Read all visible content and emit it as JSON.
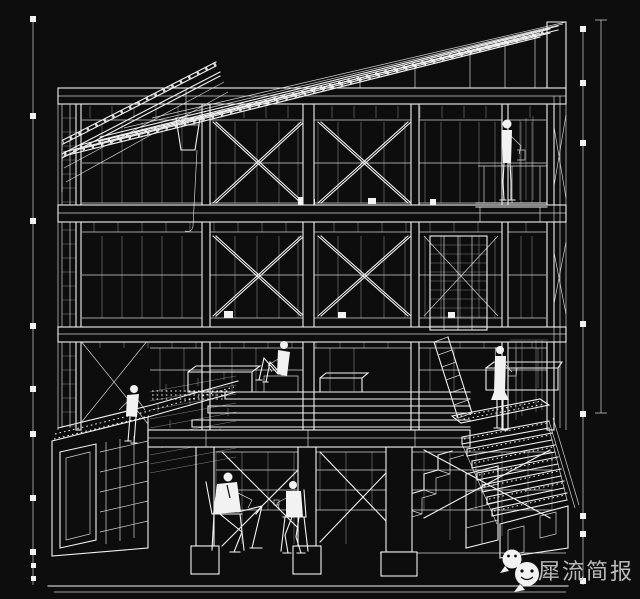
{
  "canvas": {
    "width": 640,
    "height": 599,
    "background": "#0d0d0d",
    "line_color": "#f2f2f2"
  },
  "drawing": {
    "kind": "sectional-perspective-architecture-line-drawing",
    "elements": [
      "roof-rafters",
      "cross-braced-frame",
      "window-walls",
      "ground-deck",
      "basement",
      "right-staircase",
      "ladder",
      "green-roof-box",
      "dimension-lines",
      "human-figures"
    ]
  },
  "watermark": {
    "text": "犀流简报",
    "color": "#c9c9c9",
    "icon": "wechat-logo"
  }
}
